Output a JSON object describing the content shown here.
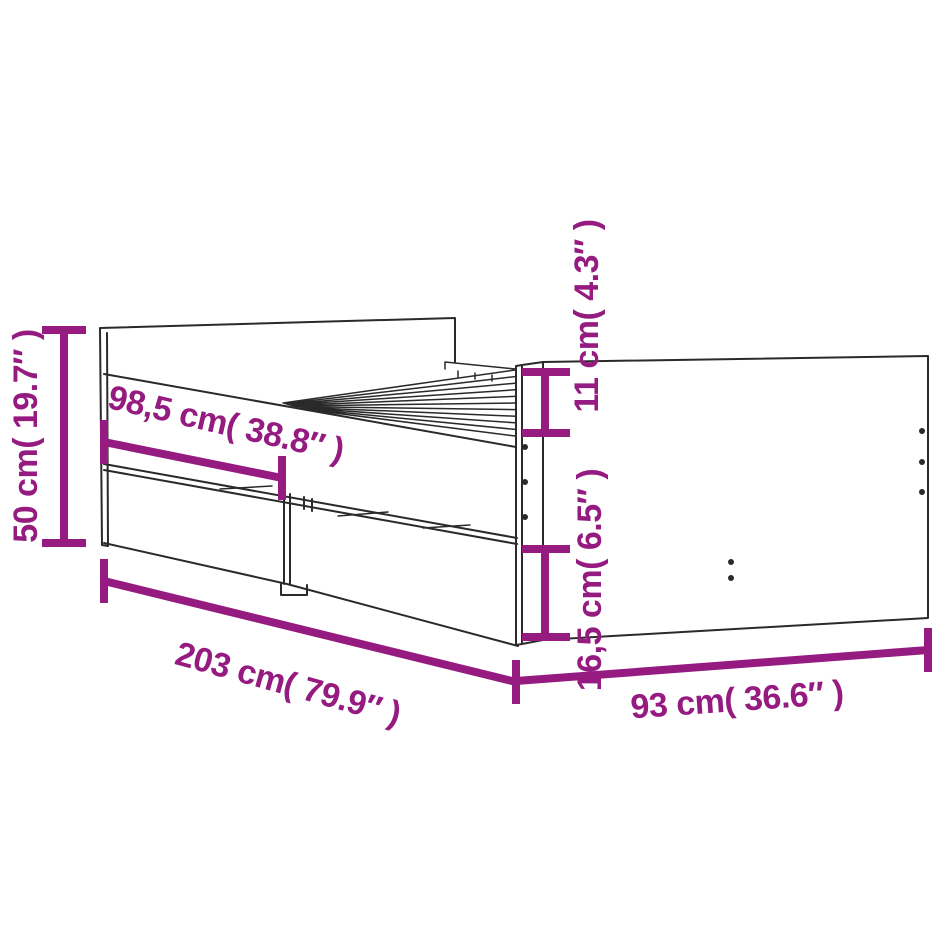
{
  "page": {
    "background": "#ffffff"
  },
  "diagram": {
    "subject": "bed-frame-with-drawers-dimension-diagram",
    "colors": {
      "dimension_accent": "#951b81",
      "line_ink": "#2a2a2a",
      "background": "#ffffff"
    },
    "dimensions": {
      "overall_height": {
        "label": "50 cm( 19.7″ )",
        "cm": "50",
        "inches": "19.7"
      },
      "drawer_front_length": {
        "label": "98,5 cm( 38.8″ )",
        "cm": "98,5",
        "inches": "38.8"
      },
      "top_section_height": {
        "label": "11 cm( 4.3″ )",
        "cm": "11",
        "inches": "4.3"
      },
      "drawer_section_height": {
        "label": "16,5 cm( 6.5″ )",
        "cm": "16,5",
        "inches": "6.5"
      },
      "overall_length": {
        "label": "203 cm( 79.9″ )",
        "cm": "203",
        "inches": "79.9"
      },
      "overall_width": {
        "label": "93 cm( 36.6″ )",
        "cm": "93",
        "inches": "36.6"
      }
    }
  }
}
